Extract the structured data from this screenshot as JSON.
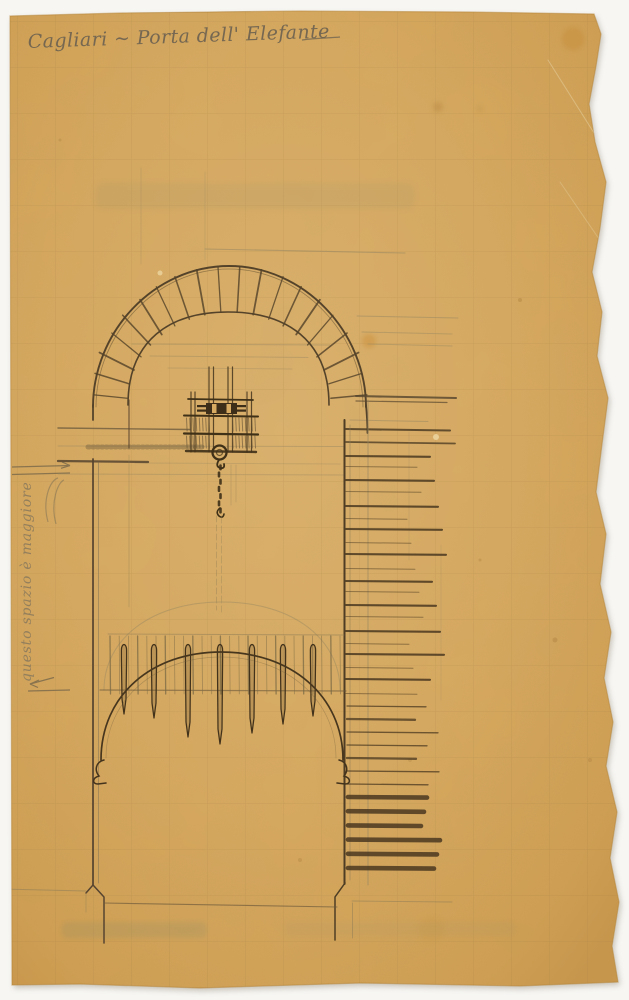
{
  "document": {
    "kind": "Scanned hand-drawn architectural sketch on aged squared paper with torn right edge",
    "subject": "Elevation study of a city gate: round voussoir arch, portcullis grate with pointed teeth, chain and windlass lifting mechanism, coursed masonry wall section at right",
    "annotations": {
      "title": "Cagliari ~ Porta dell' Elefante",
      "side_note": "questo spazio è maggiore",
      "side_note_orientation": "rotated 90° counter-clockwise, read bottom-to-top, between two small arrows"
    }
  },
  "colors": {
    "scan_background": "#f7f6f3",
    "paper": "#d7a95f",
    "paper_center": "#dcb26d",
    "paper_edge_shadow": "#c1913f",
    "grid_line": "#926c36",
    "ink_dark": "#4a3922",
    "pencil_light": "#9b8962",
    "handwriting": "#6b6150",
    "stain_orange": "#c78f3e",
    "bleed_through": "#7d8468"
  }
}
